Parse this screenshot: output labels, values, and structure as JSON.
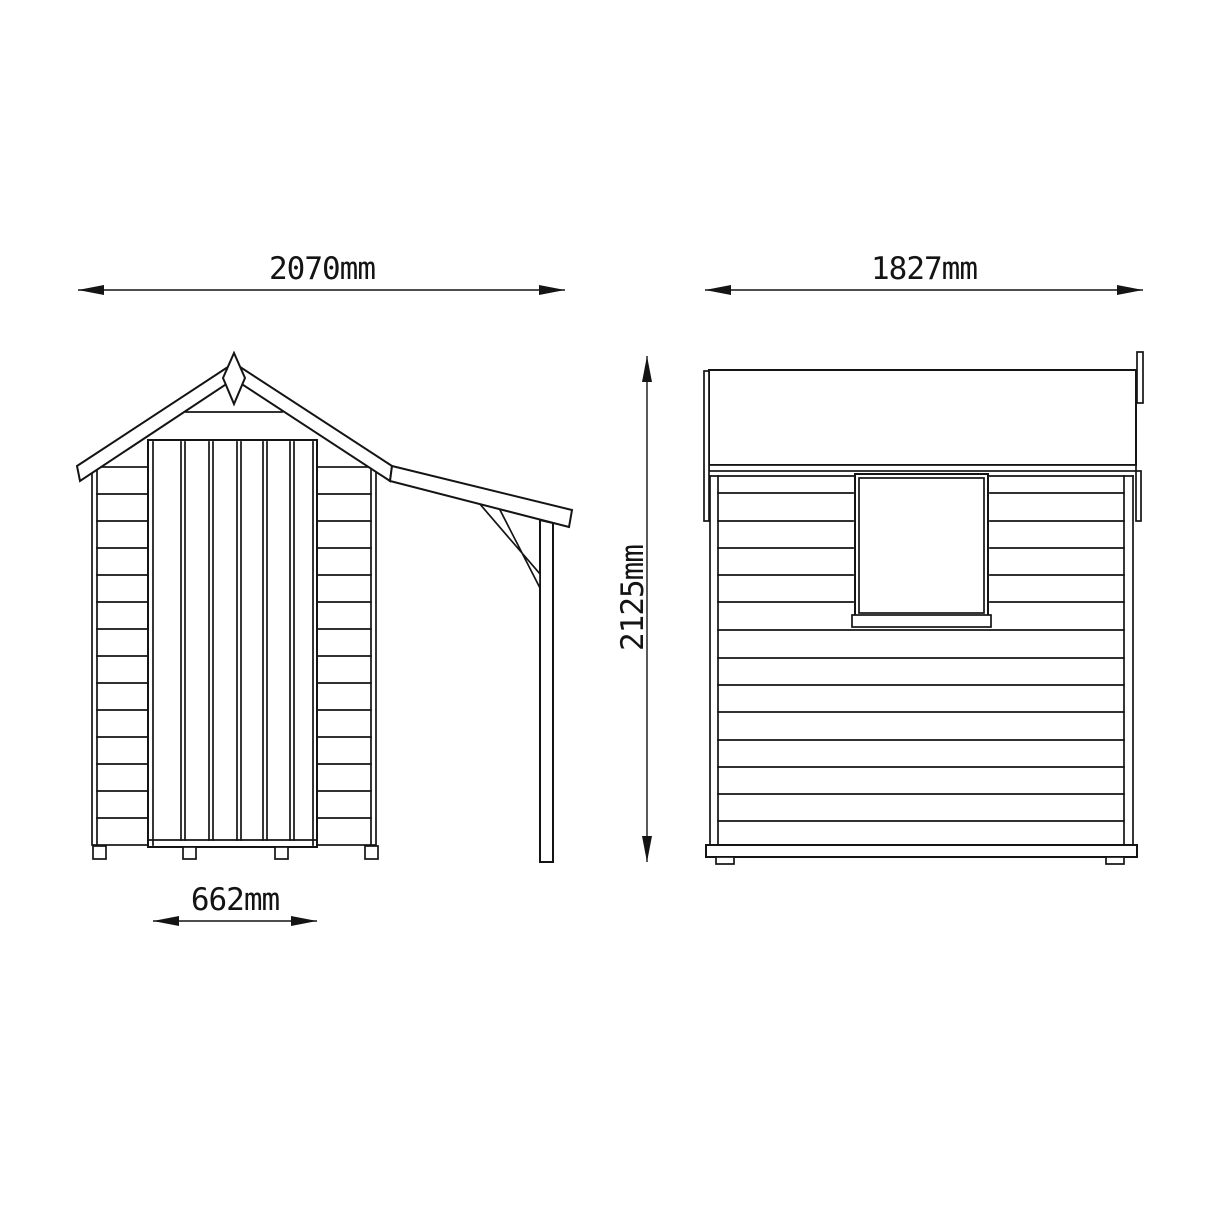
{
  "canvas": {
    "background_color": "#ffffff",
    "line_color": "#141414"
  },
  "drawing": {
    "subject": "garden shed with side log store, two elevation views",
    "dimensions": {
      "front_overall_width": "2070mm",
      "side_depth": "1827mm",
      "overall_height": "2125mm",
      "door_width": "662mm"
    }
  }
}
